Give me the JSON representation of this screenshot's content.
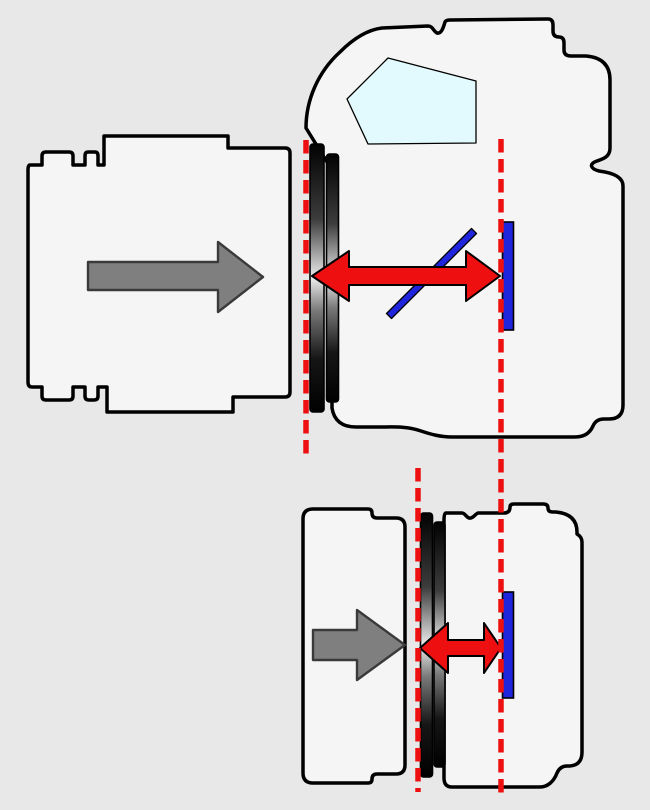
{
  "colors": {
    "background": "#e8e8e8",
    "body_fill": "#f5f5f5",
    "outline": "#000000",
    "pentaprism_fill": "#e2fafd",
    "gray_arrow_fill": "#7f7f7f",
    "red": "#ee1010",
    "blue": "#1f25dc",
    "mount_gradient": [
      "#020202",
      "#3c3c3c",
      "#ececec",
      "#7a7a7a",
      "#161616",
      "#000000"
    ]
  },
  "icons": {
    "gray_arrow": "right-arrow",
    "red_arrow": "double-headed-horizontal-arrow",
    "reference_line": "vertical-dashed-line"
  }
}
